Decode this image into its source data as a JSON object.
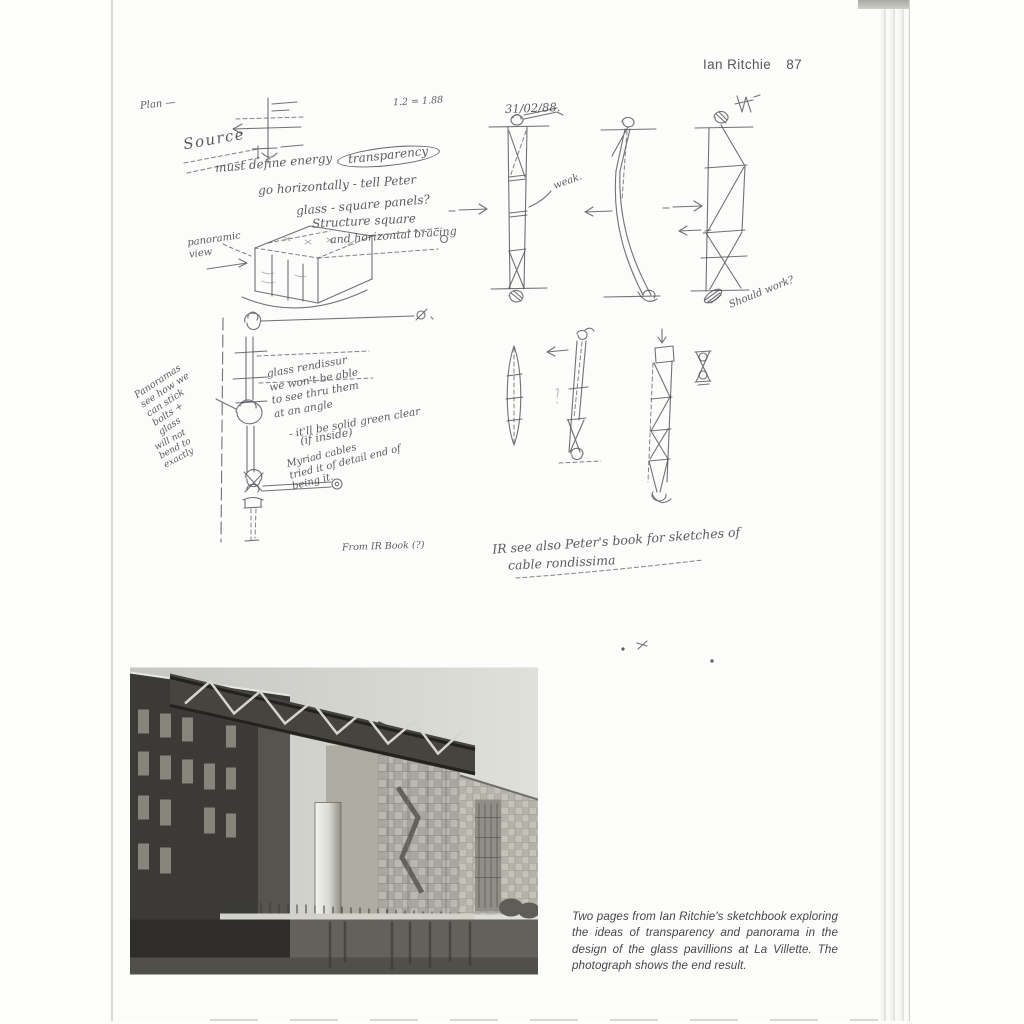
{
  "header": {
    "title": "Ian Ritchie",
    "page_number": "87"
  },
  "sketch_notes": {
    "plan_mark": "Plan —",
    "ratio_note": "1.2 = 1.88",
    "source": "Source",
    "energy_note": "must define energy",
    "transparency": "transparency",
    "horizontal_note": "go horizontally - tell Peter",
    "glass_note": "glass - square panels?",
    "structure_note": "Structure square",
    "bracing_note": "and horizontal bracing",
    "panoramic_label": "panoramic\nview",
    "sketch_date": "31/02/88.",
    "weak_label": "weak.",
    "na_mark": "N/A",
    "should_work": "Should work?",
    "stick_note": "Panoramas\nsee how we\ncan stick\nbolts +\nglass",
    "bend_note": "will not\nbend to\nexactly",
    "rendissur_note": "glass rendissur\nwe won't be able\nto see thru them\nat an angle",
    "solid_note": "- it'll be solid green clear",
    "inside_note": "(if inside)",
    "cables_note": "Myriad cables\n tried it of detail end of\n    being it.",
    "from_book": "From IR Book (?)",
    "see_also": "IR see also Peter's book for sketches of",
    "cable_underlined": "cable rondissima"
  },
  "caption": {
    "text": "Two pages from Ian Ritchie's sketchbook exploring the ideas of transparency and panorama in the design of the glass pavillions at La Villette. The photograph shows the end result."
  },
  "colors": {
    "ink": "#4e4e56",
    "paper": "#fcfcfa",
    "photo_dark": "#3b3a36"
  }
}
